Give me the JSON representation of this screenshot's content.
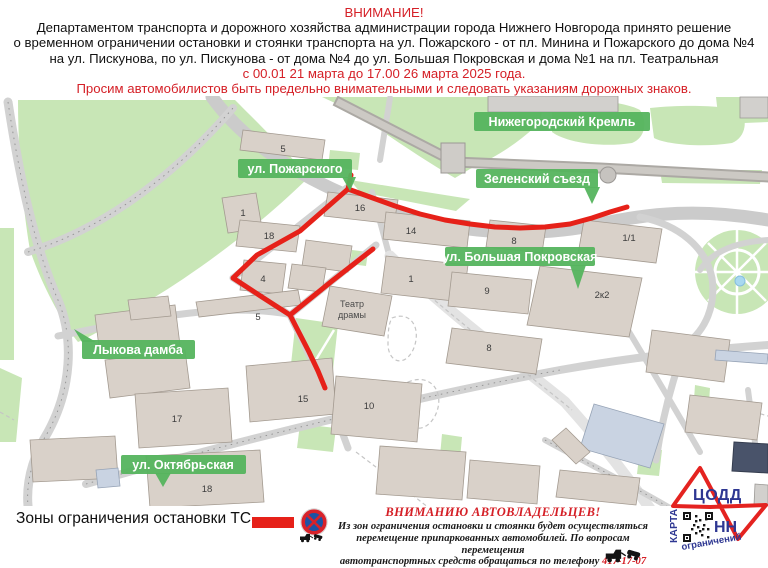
{
  "notice_header": {
    "title": "ВНИМАНИЕ!",
    "line1": "Департаментом транспорта и дорожного хозяйства администрации города Нижнего Новгорода принято решение",
    "line2": "о временном ограничении остановки и стоянки транспорта на ул. Пожарского - от пл. Минина и Пожарского до дома №4",
    "line3": "на ул. Пискунова, по ул. Пискунова - от дома №4 до ул. Большая Покровская и дома №1 на пл. Театральная",
    "date_line": "с 00.01 21 марта до 17.00 26 марта 2025 года.",
    "caution_line": "Просим автомобилистов быть предельно внимательными и следовать указаниям дорожных знаков."
  },
  "map": {
    "labels": [
      {
        "text": "Нижегородский Кремль"
      },
      {
        "text": "ул. Пожарского"
      },
      {
        "text": "Зеленский съезд"
      },
      {
        "text": "ул. Большая Покровская"
      },
      {
        "text": "Лыкова дамба"
      },
      {
        "text": "ул. Октябрьская"
      }
    ],
    "theater": {
      "line1": "Театр",
      "line2": "драмы"
    },
    "numbers": [
      {
        "text": "5"
      },
      {
        "text": "1"
      },
      {
        "text": "16"
      },
      {
        "text": "18"
      },
      {
        "text": "4"
      },
      {
        "text": "5"
      },
      {
        "text": "14"
      },
      {
        "text": "8"
      },
      {
        "text": "1/1"
      },
      {
        "text": "1"
      },
      {
        "text": "9"
      },
      {
        "text": "2к2"
      },
      {
        "text": "8"
      },
      {
        "text": "17"
      },
      {
        "text": "15"
      },
      {
        "text": "10"
      },
      {
        "text": "18"
      }
    ],
    "routes": [
      {
        "name": "ul-piskunova-zelensky",
        "points": "351,175 348,189 370,197 395,206 420,214 445,220 470,224 495,227 520,228 545,227 570,224 592,218 610,212 627,207"
      },
      {
        "name": "ul-pozharskogo",
        "points": "348,189 300,231 257,255 233,278 262,297 290,315 309,352 318,371 325,388"
      },
      {
        "name": "teatralnaya-branch",
        "points": "290,315 332,281 373,249"
      }
    ]
  },
  "legend": {
    "label": "Зоны ограничения остановки ТС -"
  },
  "owners_notice": {
    "title": "ВНИМАНИЮ АВТОВЛАДЕЛЬЦЕВ!",
    "line1": "Из зон ограничения остановки и стоянки будет осуществляться",
    "line2": "перемещение припаркованных автомобилей. По вопросам перемещения",
    "line3_prefix": "автотранспортных средств обращаться по телефону ",
    "phone": "417-17-07"
  },
  "logo": {
    "org": "ЦОДД",
    "region": "НН",
    "karta": "КАРТА",
    "ogranicheniy": "ограничений"
  },
  "colors": {
    "accent_red": "#e62119",
    "notice_red": "#d52027",
    "label_green": "#55b45e",
    "logo_blue": "#2e3792",
    "logo_red": "#e42320",
    "sign_blue": "#1c53a5",
    "sign_red": "#d8222a"
  }
}
